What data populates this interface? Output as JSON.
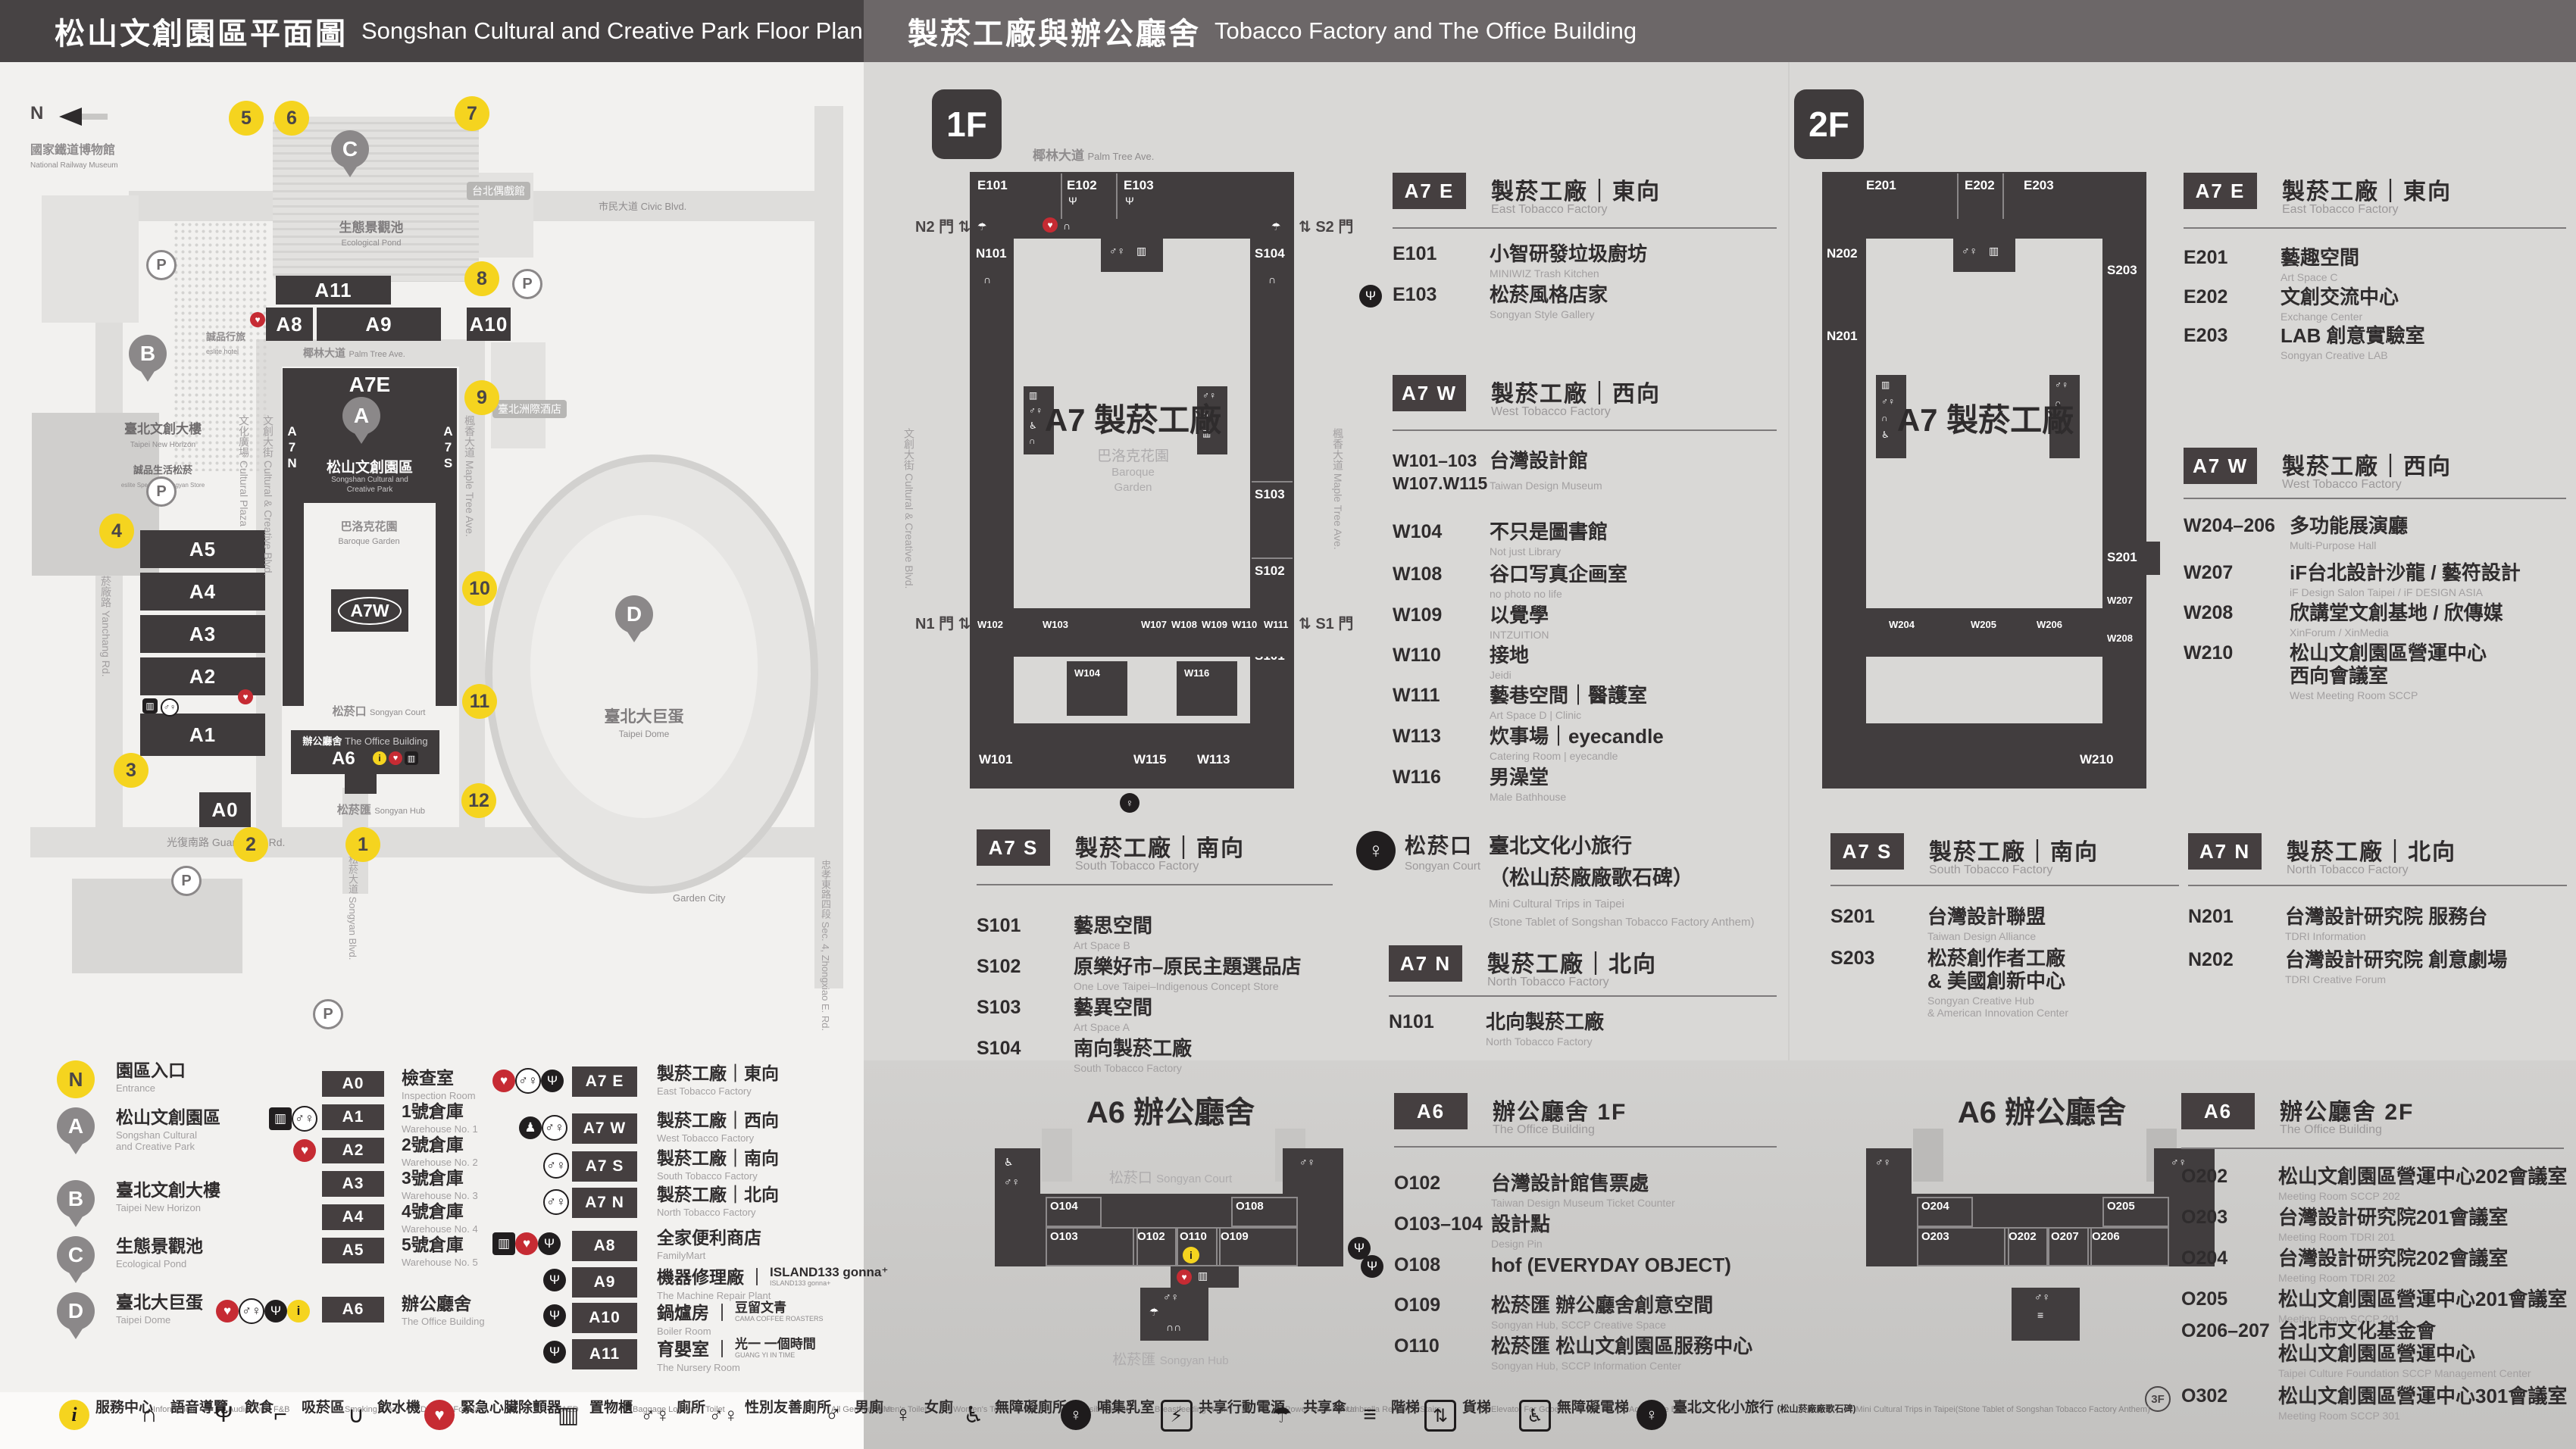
{
  "header": {
    "left_zh": "松山文創園區平面圖",
    "left_en": "Songshan Cultural and Creative Park Floor Plan",
    "right_zh": "製菸工廠與辦公廳舍",
    "right_en": "Tobacco Factory and The Office Building"
  },
  "badges": {
    "f1": "1F",
    "f2": "2F"
  },
  "map": {
    "compass": "N",
    "labels": {
      "railway_zh": "國家鐵道博物館",
      "railway_en": "National Railway Museum",
      "eslite_hotel_zh": "誠品行旅",
      "eslite_hotel_en": "eslite hotel",
      "horizon_zh": "臺北文創大樓",
      "horizon_en": "Taipei New Horizon",
      "spectrum_zh": "誠品生活松菸",
      "spectrum_en": "eslite Spectrum Songyan Store",
      "pond_zh": "生態景觀池",
      "pond_en": "Ecological Pond",
      "park_zh": "松山文創園區",
      "park_en1": "Songshan Cultural and",
      "park_en2": "Creative Park",
      "baroque_zh": "巴洛克花園",
      "baroque_en": "Baroque Garden",
      "court_zh": "松菸口",
      "court_en": "Songyan Court",
      "office_zh": "辦公廳舍",
      "office_en": "The Office Building",
      "hub_zh": "松菸匯",
      "hub_en": "Songyan Hub",
      "dome_zh": "臺北大巨蛋",
      "dome_en": "Taipei Dome",
      "tag1": "台北偶戲館",
      "tag2": "臺北洲際酒店",
      "garden_city": "Garden City"
    },
    "streets": {
      "civic": "市民大道 Civic Blvd.",
      "palm_zh": "椰林大道",
      "palm_en": "Palm Tree Ave.",
      "plaza": "文化廣場 Cultural Plaza",
      "creative": "文創大街 Cultural & Creative Blvd.",
      "maple": "楓香大道 Maple Tree Ave.",
      "yanchang": "菸廠路 Yanchang Rd.",
      "songyan": "松菸大道 Songyan Blvd.",
      "zhongxiao": "忠孝東路四段 Sec. 4, Zhongxiao E. Rd.",
      "guangfu": "光復南路 Guangfu S. Rd."
    },
    "bld": {
      "a11": "A11",
      "a8": "A8",
      "a9": "A9",
      "a10": "A10",
      "a7e": "A7E",
      "a7w": "A7W",
      "a7n": "A7N",
      "a7s": "A7S",
      "a5": "A5",
      "a4": "A4",
      "a3": "A3",
      "a2": "A2",
      "a1": "A1",
      "a0": "A0",
      "a6": "A6"
    },
    "pins": {
      "a": "A",
      "b": "B",
      "c": "C",
      "d": "D"
    },
    "parking": "P",
    "entrances": [
      "1",
      "2",
      "3",
      "4",
      "5",
      "6",
      "7",
      "8",
      "9",
      "10",
      "11",
      "12"
    ]
  },
  "plans": {
    "f1": {
      "street_top_zh": "椰林大道",
      "street_top_en": "Palm Tree Ave.",
      "left_street": "文創大街 Cultural & Creative Blvd.",
      "right_street": "楓香大道 Maple Tree Ave.",
      "gate_n2": "N2 門",
      "gate_s2": "S2 門",
      "gate_n1": "N1 門",
      "gate_s1": "S1 門",
      "center": "A7 製菸工廠",
      "garden_zh": "巴洛克花園",
      "garden_en1": "Baroque",
      "garden_en2": "Garden",
      "rooms": {
        "e101": "E101",
        "e102": "E102",
        "e103": "E103",
        "n101": "N101",
        "s104": "S104",
        "s103": "S103",
        "s102": "S102",
        "s101": "S101",
        "w102": "W102",
        "w103": "W103",
        "w107": "W107",
        "w108": "W108",
        "w109": "W109",
        "w110": "W110",
        "w111": "W111",
        "w104": "W104",
        "w116": "W116",
        "w101": "W101",
        "w115": "W115",
        "w113": "W113"
      }
    },
    "f2": {
      "center": "A7 製菸工廠",
      "rooms": {
        "e201": "E201",
        "e202": "E202",
        "e203": "E203",
        "n202": "N202",
        "n201": "N201",
        "s203": "S203",
        "s201": "S201",
        "w204": "W204",
        "w205": "W205",
        "w206": "W206",
        "w207": "W207",
        "w208": "W208",
        "w210": "W210"
      }
    },
    "a6f1": {
      "title": "A6 辦公廳舍",
      "court_zh": "松菸口",
      "court_en": "Songyan Court",
      "hub_zh": "松菸匯",
      "hub_en": "Songyan Hub",
      "rooms": {
        "o104": "O104",
        "o103": "O103",
        "o102": "O102",
        "o110": "O110",
        "o109": "O109",
        "o108": "O108"
      }
    },
    "a6f2": {
      "title": "A6 辦公廳舍",
      "rooms": {
        "o204": "O204",
        "o203": "O203",
        "o202": "O202",
        "o207": "O207",
        "o206": "O206",
        "o205": "O205"
      }
    }
  },
  "sections": {
    "a7e_1f": {
      "badge": "A7 E",
      "zh": "製菸工廠｜東向",
      "en": "East Tobacco Factory",
      "rooms": [
        {
          "code": "E101",
          "zh": "小智研發垃圾廚坊",
          "en": "MINIWIZ Trash Kitchen"
        },
        {
          "code": "E103",
          "zh": "松菸風格店家",
          "en": "Songyan Style Gallery"
        }
      ]
    },
    "a7w_1f": {
      "badge": "A7 W",
      "zh": "製菸工廠｜西向",
      "en": "West Tobacco Factory",
      "rooms": [
        {
          "code": "W101–103",
          "code2": "W107.W115",
          "zh": "台灣設計館",
          "en": "Taiwan Design Museum"
        },
        {
          "code": "W104",
          "zh": "不只是圖書館",
          "en": "Not just Library"
        },
        {
          "code": "W108",
          "zh": "谷口写真企画室",
          "en": "no photo no life"
        },
        {
          "code": "W109",
          "zh": "以覺學",
          "en": "INTZUITION"
        },
        {
          "code": "W110",
          "zh": "接地",
          "en": "Jeidi"
        },
        {
          "code": "W111",
          "zh": "藝巷空間｜醫護室",
          "en": "Art Space D | Clinic"
        },
        {
          "code": "W113",
          "zh": "炊事場｜eyecandle",
          "en": "Catering Room | eyecandle"
        },
        {
          "code": "W116",
          "zh": "男澡堂",
          "en": "Male Bathhouse"
        }
      ]
    },
    "a7s_1f": {
      "badge": "A7 S",
      "zh": "製菸工廠｜南向",
      "en": "South Tobacco Factory",
      "rooms": [
        {
          "code": "S101",
          "zh": "藝思空間",
          "en": "Art Space B"
        },
        {
          "code": "S102",
          "zh": "原樂好市–原民主題選品店",
          "en": "One Love Taipei–Indigenous Concept Store"
        },
        {
          "code": "S103",
          "zh": "藝異空間",
          "en": "Art Space A"
        },
        {
          "code": "S104",
          "zh": "南向製菸工廠",
          "en": "South Tobacco Factory"
        }
      ]
    },
    "court_1f": {
      "zh": "松菸口",
      "en": "Songyan Court",
      "t1": "臺北文化小旅行",
      "t2": "（松山菸廠廠歌石碑）",
      "e1": "Mini Cultural Trips in Taipei",
      "e2": "(Stone Tablet of Songshan Tobacco Factory Anthem)"
    },
    "a7n_1f": {
      "badge": "A7 N",
      "zh": "製菸工廠｜北向",
      "en": "North Tobacco Factory",
      "rooms": [
        {
          "code": "N101",
          "zh": "北向製菸工廠",
          "en": "North Tobacco Factory"
        }
      ]
    },
    "a6_1f": {
      "badge": "A6",
      "zh": "辦公廳舍 1F",
      "en": "The Office Building",
      "rooms": [
        {
          "code": "O102",
          "zh": "台灣設計館售票處",
          "en": "Taiwan Design Museum Ticket Counter"
        },
        {
          "code": "O103–104",
          "zh": "設計點",
          "en": "Design Pin"
        },
        {
          "code": "O108",
          "zh": "hof (EVERYDAY OBJECT)",
          "en": ""
        },
        {
          "code": "O109",
          "zh": "松菸匯 辦公廳舍創意空間",
          "en": "Songyan Hub, SCCP Creative Space"
        },
        {
          "code": "O110",
          "zh": "松菸匯 松山文創園區服務中心",
          "en": "Songyan Hub, SCCP Information Center"
        }
      ]
    },
    "a7e_2f": {
      "badge": "A7 E",
      "zh": "製菸工廠｜東向",
      "en": "East Tobacco Factory",
      "rooms": [
        {
          "code": "E201",
          "zh": "藝趣空間",
          "en": "Art Space C"
        },
        {
          "code": "E202",
          "zh": "文創交流中心",
          "en": "Exchange Center"
        },
        {
          "code": "E203",
          "zh": "LAB 創意實驗室",
          "en": "Songyan Creative LAB"
        }
      ]
    },
    "a7w_2f": {
      "badge": "A7 W",
      "zh": "製菸工廠｜西向",
      "en": "West Tobacco Factory",
      "rooms": [
        {
          "code": "W204–206",
          "zh": "多功能展演廳",
          "en": "Multi-Purpose Hall"
        },
        {
          "code": "W207",
          "zh": "iF台北設計沙龍 / 藝符設計",
          "en": "iF Design Salon Taipei / iF DESIGN ASIA"
        },
        {
          "code": "W208",
          "zh": "欣講堂文創基地 / 欣傳媒",
          "en": "XinForum / XinMedia"
        },
        {
          "code": "W210",
          "zh": "松山文創園區營運中心",
          "zh2": "西向會議室",
          "en": "West Meeting Room SCCP"
        }
      ]
    },
    "a7s_2f": {
      "badge": "A7 S",
      "zh": "製菸工廠｜南向",
      "en": "South Tobacco Factory",
      "rooms": [
        {
          "code": "S201",
          "zh": "台灣設計聯盟",
          "en": "Taiwan Design Alliance"
        },
        {
          "code": "S203",
          "zh": "松菸創作者工廠",
          "zh2": "& 美國創新中心",
          "en": "Songyan Creative Hub",
          "en2": "& American Innovation Center"
        }
      ]
    },
    "a7n_2f": {
      "badge": "A7 N",
      "zh": "製菸工廠｜北向",
      "en": "North Tobacco Factory",
      "rooms": [
        {
          "code": "N201",
          "zh": "台灣設計研究院 服務台",
          "en": "TDRI Information"
        },
        {
          "code": "N202",
          "zh": "台灣設計研究院 創意劇場",
          "en": "TDRI Creative Forum"
        }
      ]
    },
    "a6_2f": {
      "badge": "A6",
      "zh": "辦公廳舍 2F",
      "en": "The Office Building",
      "rooms": [
        {
          "code": "O202",
          "zh": "松山文創園區營運中心202會議室",
          "en": "Meeting Room SCCP 202"
        },
        {
          "code": "O203",
          "zh": "台灣設計研究院201會議室",
          "en": "Meeting Room TDRI 201"
        },
        {
          "code": "O204",
          "zh": "台灣設計研究院202會議室",
          "en": "Meeting Room TDRI 202"
        },
        {
          "code": "O205",
          "zh": "松山文創園區營運中心201會議室",
          "en": "Meeting Room SCCP 201"
        },
        {
          "code": "O206–207",
          "zh": "台北市文化基金會",
          "zh2": "松山文創園區營運中心",
          "en": "Taipei Culture Foundation SCCP Management Center"
        },
        {
          "code": "O302",
          "prefix": "3F",
          "zh": "松山文創園區營運中心301會議室",
          "en": "Meeting Room SCCP 301"
        }
      ]
    }
  },
  "legend": {
    "places": [
      {
        "badge": "N",
        "zh": "園區入口",
        "en": "Entrance"
      },
      {
        "badge": "A",
        "zh": "松山文創園區",
        "en": "Songshan Cultural",
        "en2": "and Creative Park"
      },
      {
        "badge": "B",
        "zh": "臺北文創大樓",
        "en": "Taipei New Horizon"
      },
      {
        "badge": "C",
        "zh": "生態景觀池",
        "en": "Ecological Pond"
      },
      {
        "badge": "D",
        "zh": "臺北大巨蛋",
        "en": "Taipei Dome"
      }
    ],
    "col1": [
      {
        "badge": "A0",
        "zh": "檢查室",
        "en": "Inspection Room"
      },
      {
        "badge": "A1",
        "zh": "1號倉庫",
        "en": "Warehouse No. 1"
      },
      {
        "badge": "A2",
        "zh": "2號倉庫",
        "en": "Warehouse No. 2"
      },
      {
        "badge": "A3",
        "zh": "3號倉庫",
        "en": "Warehouse No. 3"
      },
      {
        "badge": "A4",
        "zh": "4號倉庫",
        "en": "Warehouse No. 4"
      },
      {
        "badge": "A5",
        "zh": "5號倉庫",
        "en": "Warehouse No. 5"
      },
      {
        "badge": "A6",
        "zh": "辦公廳舍",
        "en": "The Office Building"
      }
    ],
    "col2": [
      {
        "badge": "A7 E",
        "zh": "製菸工廠｜東向",
        "en": "East Tobacco Factory"
      },
      {
        "badge": "A7 W",
        "zh": "製菸工廠｜西向",
        "en": "West Tobacco Factory"
      },
      {
        "badge": "A7 S",
        "zh": "製菸工廠｜南向",
        "en": "South Tobacco Factory"
      },
      {
        "badge": "A7 N",
        "zh": "製菸工廠｜北向",
        "en": "North Tobacco Factory"
      },
      {
        "badge": "A8",
        "zh": "全家便利商店",
        "en": "FamilyMart"
      },
      {
        "badge": "A9",
        "zh": "機器修理廠",
        "en": "The Machine Repair Plant",
        "brand": "ISLAND133 gonna⁺",
        "brand_sub": "ISLAND133 gonna+"
      },
      {
        "badge": "A10",
        "zh": "鍋爐房",
        "en": "Boiler Room",
        "brand": "豆留文青",
        "brand_sub": "CAMA COFFEE ROASTERS"
      },
      {
        "badge": "A11",
        "zh": "育嬰室",
        "en": "The Nursery Room",
        "brand": "光一 一個時間",
        "brand_sub": "GUANG YI IN TIME"
      }
    ]
  },
  "facilities": [
    {
      "zh": "服務中心",
      "en": "Information"
    },
    {
      "zh": "語音導覽",
      "en": "Audio Tour"
    },
    {
      "zh": "飲食",
      "en": "F&B"
    },
    {
      "zh": "吸菸區",
      "en": "Smoking Area"
    },
    {
      "zh": "飲水機",
      "en": "Drinking Fountain"
    },
    {
      "zh": "緊急心臟除顫器",
      "en": "AED"
    },
    {
      "zh": "置物櫃",
      "en": "Baggage Lockers"
    },
    {
      "zh": "廁所",
      "en": "Toilet"
    },
    {
      "zh": "性別友善廁所",
      "en": "All Gender Toilet"
    },
    {
      "zh": "男廁",
      "en": "Men's Toilet"
    },
    {
      "zh": "女廁",
      "en": "Women's Toilet"
    },
    {
      "zh": "無障礙廁所",
      "en": "Accessible Toilet"
    },
    {
      "zh": "哺集乳室",
      "en": "Breastfeeding Room"
    },
    {
      "zh": "共享行動電源",
      "en": "Power Bank Rental"
    },
    {
      "zh": "共享傘",
      "en": "Umbrella Rental"
    },
    {
      "zh": "階梯",
      "en": "Stairs"
    },
    {
      "zh": "貨梯",
      "en": "Elevator For Goods"
    },
    {
      "zh": "無障礙電梯",
      "en": "Accessible Elevator"
    },
    {
      "zh": "臺北文化小旅行",
      "zh2": "(松山菸廠廠歌石碑)",
      "en": "Mini Cultural Trips in Taipei",
      "en2": "(Stone Tablet of Songshan Tobacco Factory Anthem)"
    }
  ]
}
